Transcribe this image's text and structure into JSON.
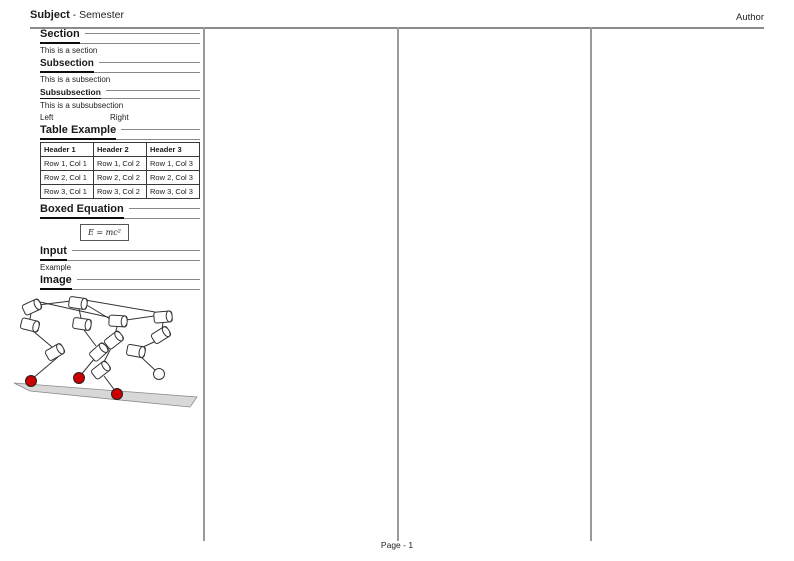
{
  "header": {
    "subject": "Subject",
    "suffix": " - Semester",
    "author": "Author"
  },
  "col1": {
    "section": {
      "title": "Section",
      "body": "This is a section"
    },
    "subsection": {
      "title": "Subsection",
      "body": "This is a subsection"
    },
    "subsubsection": {
      "title": "Subsubsection",
      "body": "This is a subsubsection"
    },
    "two_col": {
      "left": "Left",
      "right": "Right"
    },
    "table": {
      "title": "Table Example",
      "headers": [
        "Header 1",
        "Header 2",
        "Header 3"
      ],
      "rows": [
        [
          "Row 1, Col 1",
          "Row 1, Col 2",
          "Row 1, Col 3"
        ],
        [
          "Row 2, Col 1",
          "Row 2, Col 2",
          "Row 2, Col 3"
        ],
        [
          "Row 3, Col 1",
          "Row 3, Col 2",
          "Row 3, Col 3"
        ]
      ]
    },
    "boxed_equation": {
      "title": "Boxed Equation",
      "equation": "E = mc²"
    },
    "input": {
      "title": "Input",
      "body": "Example"
    },
    "image": {
      "title": "Image"
    }
  },
  "figure": {
    "foot_color": "#cc0000",
    "ground_color": "#d8d8d8",
    "line_color": "#333333"
  },
  "footer": {
    "page": "Page - 1"
  }
}
